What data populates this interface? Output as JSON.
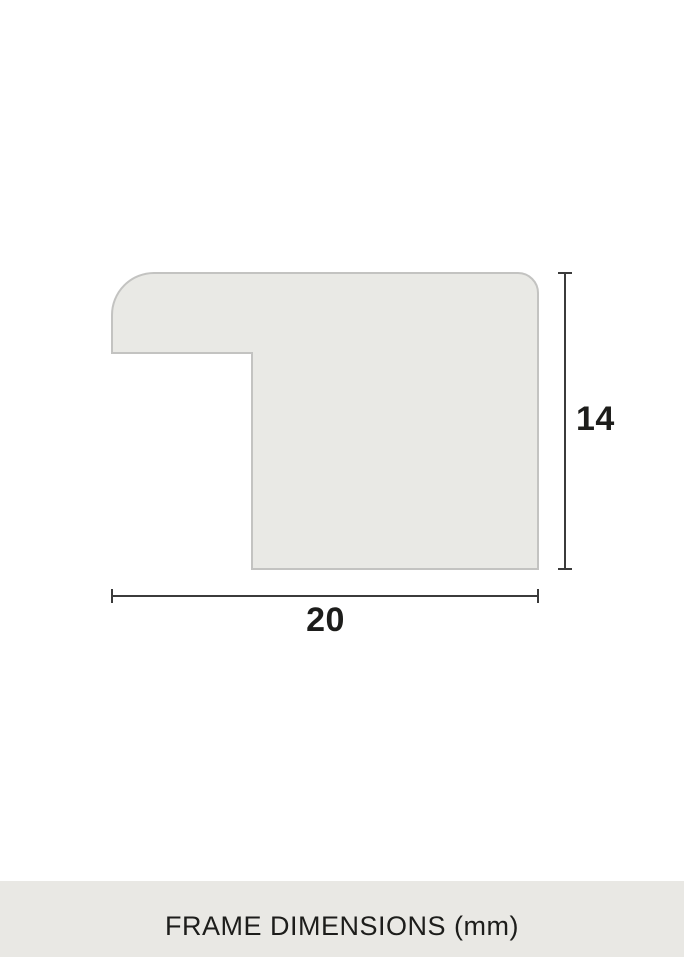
{
  "diagram": {
    "type": "frame-moulding-cross-section",
    "width_label": "20",
    "height_label": "14",
    "unit": "mm",
    "dimensions": {
      "width_mm": 20,
      "height_mm": 14
    }
  },
  "caption": {
    "text": "FRAME DIMENSIONS (mm)"
  },
  "colors": {
    "background": "#ffffff",
    "shape_fill": "#e9e9e5",
    "shape_stroke": "#c3c3c1",
    "dimension_line": "#3b3b3b",
    "label_text": "#1d1d1b",
    "caption_band": "#e9e8e4",
    "caption_text": "#1d1d1b"
  }
}
